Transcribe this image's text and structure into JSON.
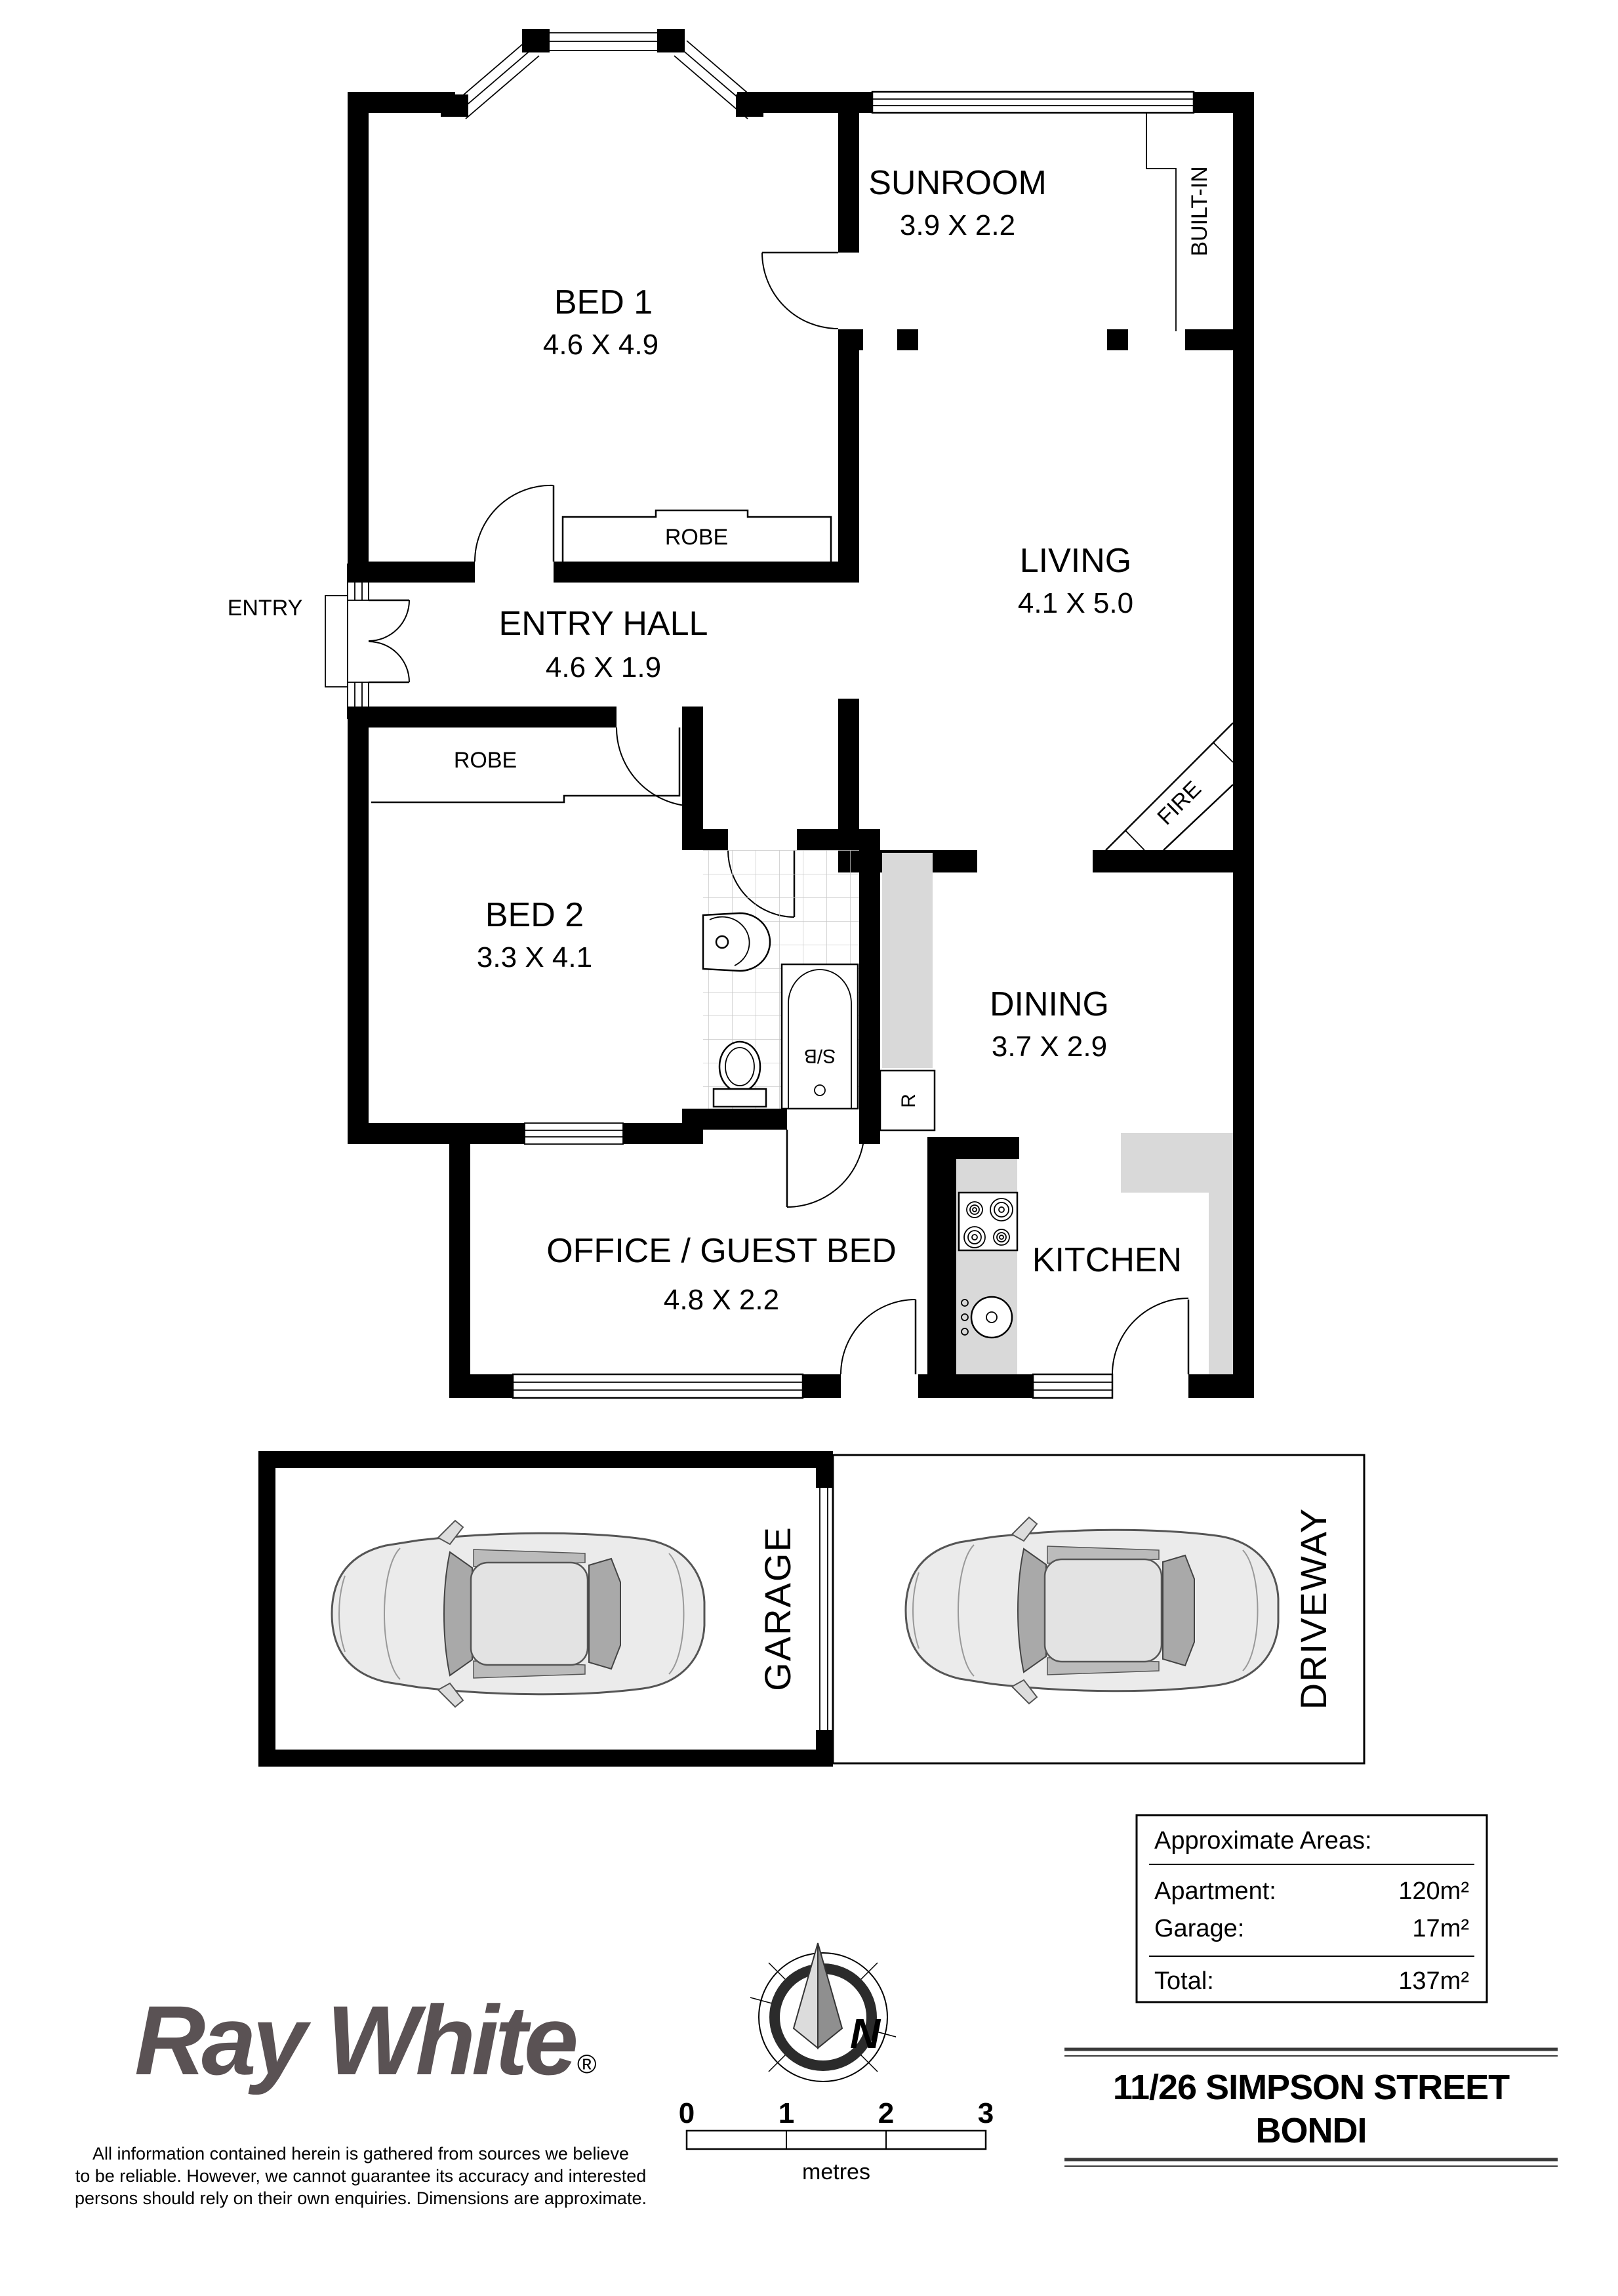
{
  "rooms": {
    "bed1": {
      "name": "BED 1",
      "dims": "4.6 X 4.9"
    },
    "sunroom": {
      "name": "SUNROOM",
      "dims": "3.9 X 2.2"
    },
    "living": {
      "name": "LIVING",
      "dims": "4.1 X 5.0"
    },
    "entry_hall": {
      "name": "ENTRY HALL",
      "dims": "4.6 X 1.9"
    },
    "bed2": {
      "name": "BED 2",
      "dims": "3.3 X 4.1"
    },
    "dining": {
      "name": "DINING",
      "dims": "3.7 X 2.9"
    },
    "office": {
      "name": "OFFICE / GUEST BED",
      "dims": "4.8 X 2.2"
    },
    "kitchen": {
      "name": "KITCHEN"
    }
  },
  "fixtures": {
    "entry": "ENTRY",
    "robe_bed1": "ROBE",
    "robe_bed2": "ROBE",
    "built_in": "BUILT-IN",
    "fire": "FIRE",
    "bath": "S/B",
    "fridge": "R"
  },
  "outdoor": {
    "garage": "GARAGE",
    "driveway": "DRIVEWAY"
  },
  "areas": {
    "title": "Approximate Areas:",
    "rows": [
      {
        "label": "Apartment:",
        "value": "120m²"
      },
      {
        "label": "Garage:",
        "value": "17m²"
      }
    ],
    "total": {
      "label": "Total:",
      "value": "137m²"
    }
  },
  "brand": {
    "name": "Ray White",
    "mark": "®",
    "color": "#5a5254"
  },
  "address": {
    "line1": "11/26 SIMPSON STREET",
    "line2": "BONDI"
  },
  "compass": {
    "label": "N"
  },
  "scalebar": {
    "ticks": [
      "0",
      "1",
      "2",
      "3"
    ],
    "unit": "metres"
  },
  "disclaimer": {
    "line1": "All information contained herein is gathered from sources we believe",
    "line2": "to be reliable. However, we cannot guarantee its accuracy and interested",
    "line3": "persons should rely on their own enquiries. Dimensions are approximate."
  }
}
